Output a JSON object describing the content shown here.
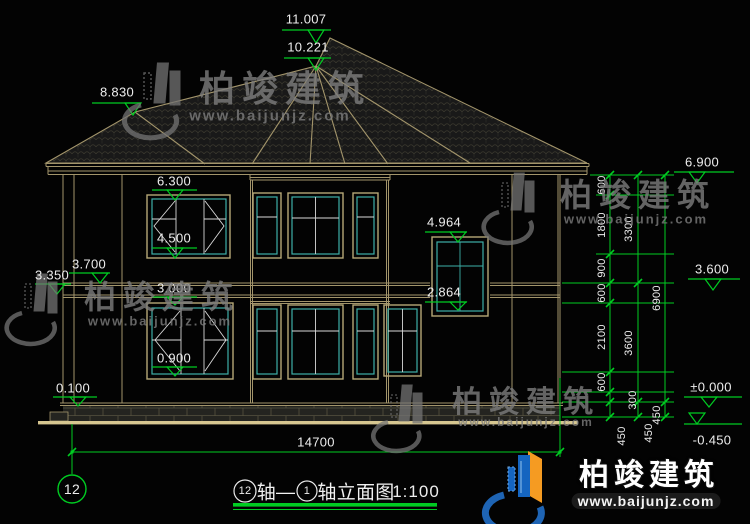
{
  "drawing": {
    "title": {
      "start_axis": "12",
      "dash": "轴—",
      "end_axis": "1",
      "name": "轴立面图",
      "scale": "1:100"
    },
    "axis_bubble": "12",
    "overall_width": "14700",
    "elevations": {
      "ridge_top": "11.007",
      "ridge_second": "10.221",
      "left_ridge": "8.830",
      "f2_window_head": "6.300",
      "f2_window_sill": "4.500",
      "left_band_top": "3.700",
      "left_band_bottom": "3.350",
      "f2_floor_band": "3.000",
      "f1_window_sill": "0.900",
      "plinth_top": "0.100",
      "stair_window_head": "4.964",
      "stair_window_sill": "2.864",
      "eave_right": "6.900",
      "f2_level": "3.600",
      "ground_zero": "±0.000",
      "site_ground": "-0.450"
    },
    "chains": {
      "inner": [
        "600",
        "1800",
        "900",
        "600",
        "2100",
        "600",
        "300",
        "450"
      ],
      "middle": [
        "3300",
        "3600",
        "450"
      ],
      "outer": [
        "6900",
        "450"
      ]
    }
  },
  "watermark": {
    "brand": "柏竣建筑",
    "url": "www.baijunjz.com"
  },
  "logo": {
    "brand": "柏竣建筑",
    "url": "www.baijunjz.com"
  },
  "colors": {
    "dim_green": "#00cc22",
    "line_tan": "#a3956b",
    "frame_tan": "#b6a877",
    "window_teal": "#3db0a8",
    "ground_tan": "#d6c690"
  }
}
